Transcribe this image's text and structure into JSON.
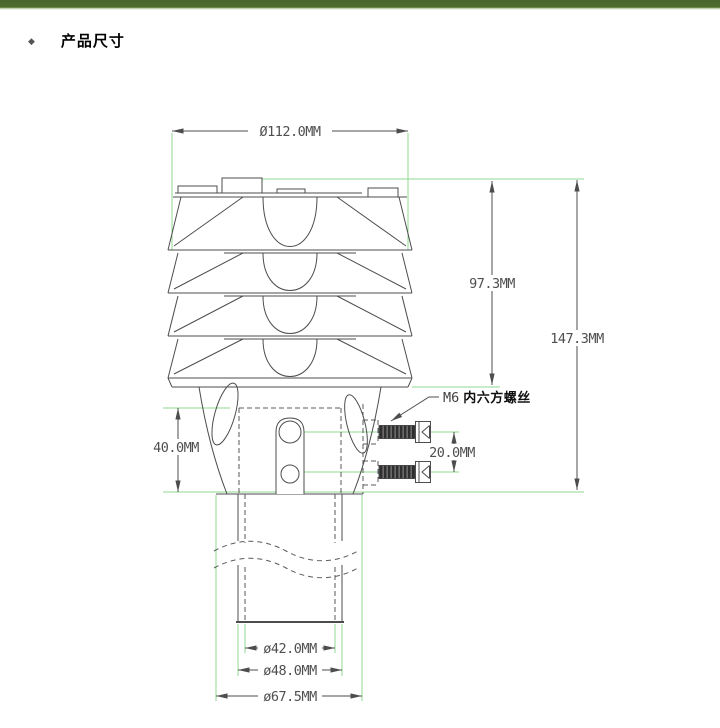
{
  "section": {
    "bullet": "◆",
    "title": "产品尺寸"
  },
  "drawing": {
    "dims": {
      "top_diameter": "Ø112.0MM",
      "shield_height": "97.3MM",
      "total_height": "147.3MM",
      "mount_height": "40.0MM",
      "screw_spacing": "20.0MM",
      "inner_diameter": "ø42.0MM",
      "pole_diameter": "ø48.0MM",
      "flange_diameter": "ø67.5MM"
    },
    "callout": {
      "size": "M6",
      "label": "内六方螺丝"
    },
    "colors": {
      "header_bar": "#48662b",
      "extension_line": "#90d890",
      "drawing_line": "#4d4d4d",
      "dimension_text": "#4f4f4f"
    }
  }
}
